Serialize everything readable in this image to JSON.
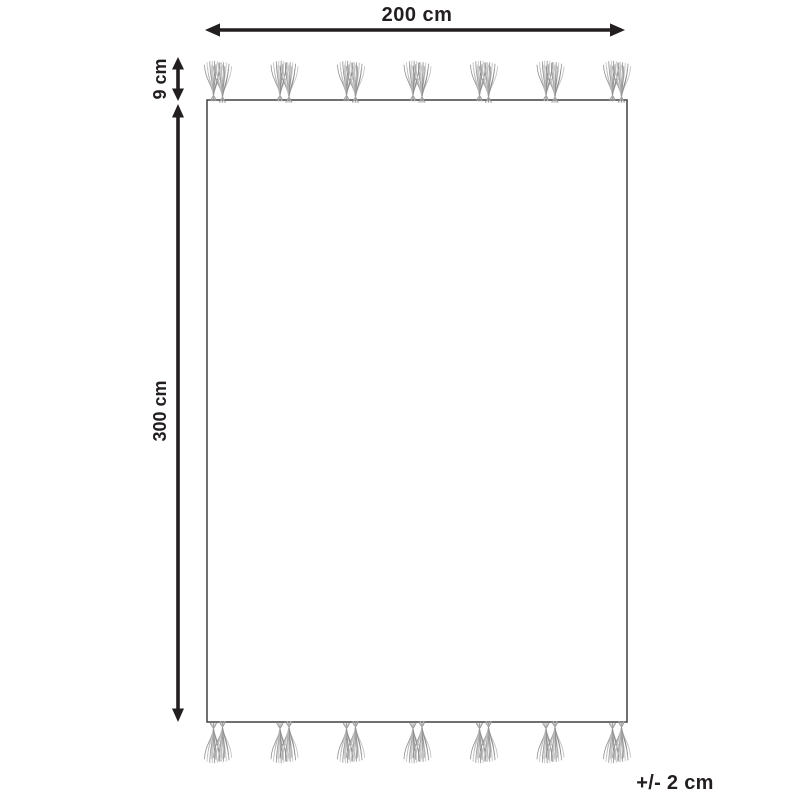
{
  "diagram": {
    "type": "rug-dimension-diagram",
    "labels": {
      "width": "200 cm",
      "height": "300 cm",
      "fringe": "9 cm",
      "tolerance": "+/- 2 cm"
    },
    "dimensions_cm": {
      "width": 200,
      "height": 300,
      "fringe": 9,
      "tolerance_plus_minus": 2
    },
    "tassels": {
      "groups_per_edge": 7,
      "tufts_per_group": 2,
      "edges": [
        "top",
        "bottom"
      ]
    },
    "colors": {
      "dimension": "#231f20",
      "rug_border": "#4d4d4d",
      "tassel_dark": "#8f8f8f",
      "tassel_light": "#bdbdbd",
      "background": "#ffffff"
    }
  }
}
